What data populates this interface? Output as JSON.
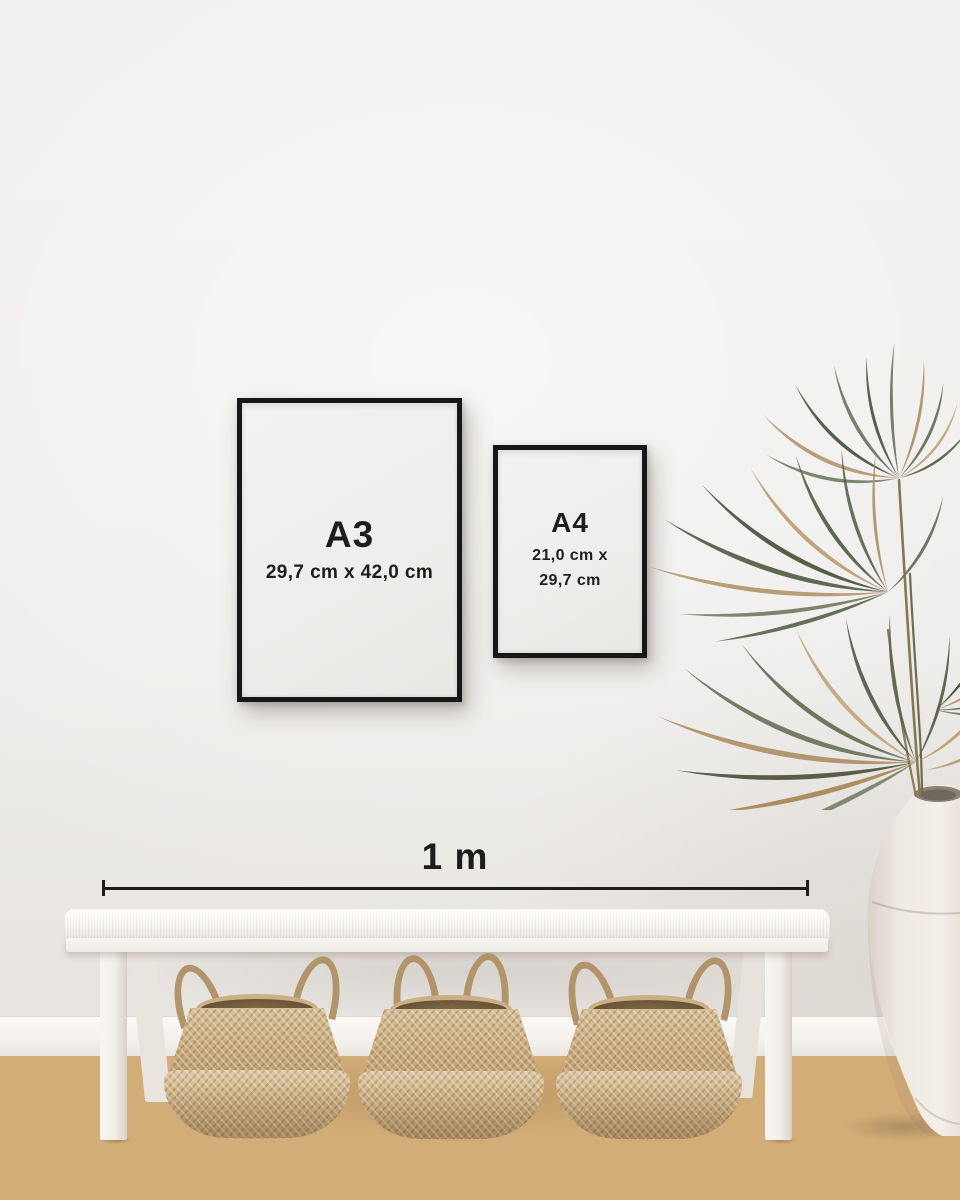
{
  "frames": {
    "a3": {
      "label": "A3",
      "dimensions": "29,7 cm x 42,0 cm"
    },
    "a4": {
      "label": "A4",
      "dimensions_line1": "21,0 cm x",
      "dimensions_line2": "29,7 cm"
    }
  },
  "scale_bar": {
    "label": "1 m"
  },
  "colors": {
    "wall": "#eeedeb",
    "baseboard": "#f6f4f0",
    "floor_wood": "#d3ad77",
    "frame_black": "#17171a",
    "poster_paper": "#f0efed",
    "text": "#1d1d1d",
    "scale_line": "#1e1e1e",
    "bench_white": "#f6f4f1",
    "basket_tan": "#c9ac7f",
    "basket_rope": "#b2946a",
    "plant_green": "#5a644b",
    "plant_dried": "#a98a5d",
    "vase_cream": "#efeae3"
  }
}
